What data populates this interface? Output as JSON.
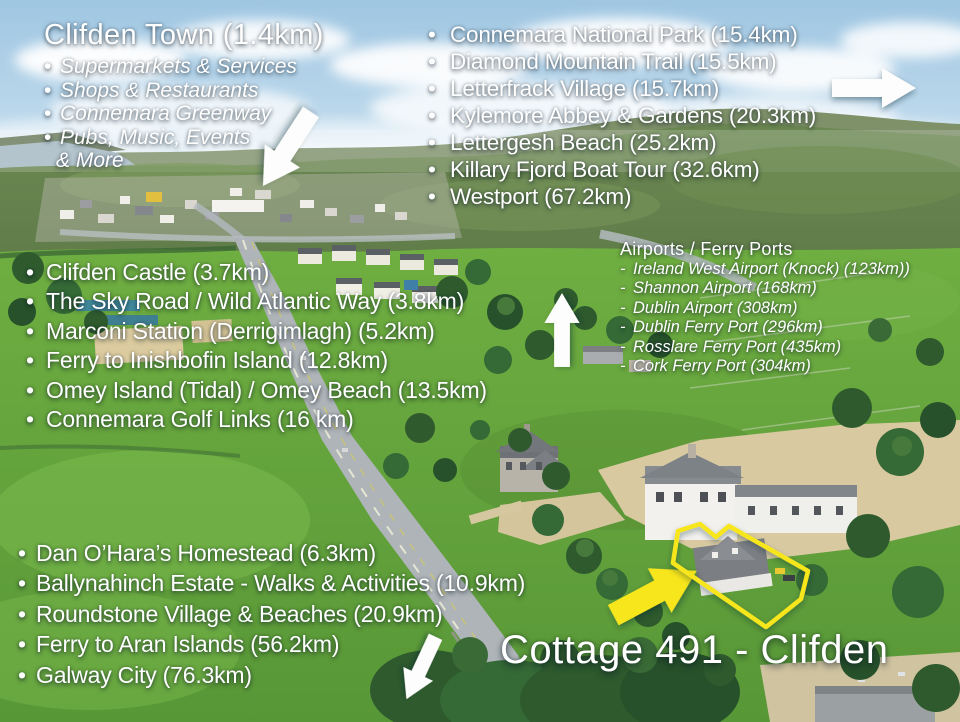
{
  "colors": {
    "accent_yellow": "#f7e61e",
    "text": "#ffffff",
    "sky": "#a6cbe4",
    "field_green": "#6cab40",
    "road_gray": "#aeb4b8"
  },
  "markers": {
    "bullet": "•",
    "dash": "-"
  },
  "blocks": {
    "town": {
      "heading": "Clifden Town (1.4km)",
      "items": [
        "Supermarkets & Services",
        "Shops & Restaurants",
        "Connemara Greenway",
        "Pubs, Music, Events"
      ],
      "continuation": "& More"
    },
    "north": {
      "items": [
        "Connemara National Park (15.4km)",
        "Diamond Mountain Trail (15.5km)",
        "Letterfrack Village (15.7km)",
        "Kylemore Abbey & Gardens (20.3km)",
        "Lettergesh Beach (25.2km)",
        "Killary Fjord Boat Tour (32.6km)",
        "Westport (67.2km)"
      ]
    },
    "west": {
      "items": [
        "Clifden Castle (3.7km)",
        "The Sky Road / Wild Atlantic Way (3.8km)",
        "Marconi Station (Derrigimlagh) (5.2km)",
        "Ferry to Inishbofin Island (12.8km)",
        "Omey Island (Tidal) / Omey Beach (13.5km)",
        "Connemara Golf Links (16 km)"
      ]
    },
    "airports": {
      "heading": "Airports / Ferry Ports",
      "items": [
        "Ireland West Airport (Knock) (123km))",
        "Shannon Airport (168km)",
        "Dublin Airport (308km)",
        "Dublin Ferry Port (296km)",
        "Rosslare Ferry Port (435km)",
        "Cork Ferry Port (304km)"
      ]
    },
    "south": {
      "items": [
        "Dan O’Hara’s Homestead (6.3km)",
        "Ballynahinch Estate - Walks & Activities (10.9km)",
        "Roundstone Village & Beaches (20.9km)",
        "Ferry to Aran Islands (56.2km)",
        "Galway City (76.3km)"
      ]
    },
    "property": {
      "title": "Cottage 491 - Clifden"
    }
  }
}
